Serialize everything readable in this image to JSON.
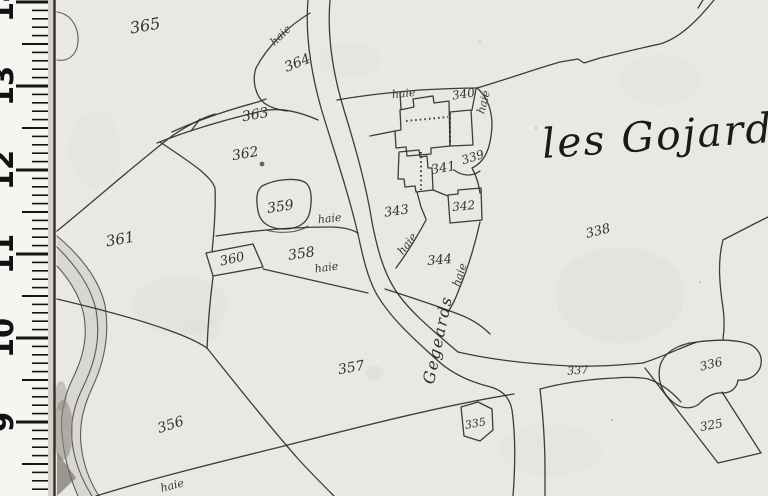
{
  "map": {
    "place_title": "les Gojards",
    "road_label": "Gegeards",
    "hedge_word": "haie",
    "ink_color": "#2f2d29",
    "paper_color": "#eae8e3",
    "parcel_numbers": [
      {
        "n": "365",
        "x": 146,
        "y": 31,
        "r": -10,
        "s": 16
      },
      {
        "n": "364",
        "x": 299,
        "y": 67,
        "r": -22,
        "s": 14
      },
      {
        "n": "363",
        "x": 256,
        "y": 119,
        "r": -10,
        "s": 14
      },
      {
        "n": "362",
        "x": 246,
        "y": 158,
        "r": -10,
        "s": 14
      },
      {
        "n": "361",
        "x": 121,
        "y": 244,
        "r": -10,
        "s": 15
      },
      {
        "n": "360",
        "x": 233,
        "y": 263,
        "r": -12,
        "s": 13
      },
      {
        "n": "359",
        "x": 281,
        "y": 211,
        "r": -8,
        "s": 14
      },
      {
        "n": "358",
        "x": 302,
        "y": 258,
        "r": -8,
        "s": 14
      },
      {
        "n": "357",
        "x": 352,
        "y": 372,
        "r": -10,
        "s": 14
      },
      {
        "n": "356",
        "x": 172,
        "y": 429,
        "r": -18,
        "s": 14
      },
      {
        "n": "343",
        "x": 397,
        "y": 215,
        "r": -8,
        "s": 13
      },
      {
        "n": "341",
        "x": 444,
        "y": 172,
        "r": -10,
        "s": 13
      },
      {
        "n": "340",
        "x": 464,
        "y": 98,
        "r": -8,
        "s": 12
      },
      {
        "n": "339",
        "x": 474,
        "y": 161,
        "r": -18,
        "s": 12
      },
      {
        "n": "342",
        "x": 464,
        "y": 210,
        "r": -5,
        "s": 12
      },
      {
        "n": "344",
        "x": 440,
        "y": 264,
        "r": -5,
        "s": 13
      },
      {
        "n": "338",
        "x": 599,
        "y": 235,
        "r": -14,
        "s": 13
      },
      {
        "n": "337",
        "x": 578,
        "y": 374,
        "r": -4,
        "s": 11
      },
      {
        "n": "336",
        "x": 712,
        "y": 368,
        "r": -14,
        "s": 12
      },
      {
        "n": "335",
        "x": 476,
        "y": 427,
        "r": -10,
        "s": 11
      },
      {
        "n": "325",
        "x": 712,
        "y": 429,
        "r": -10,
        "s": 12
      }
    ],
    "hedge_labels": [
      {
        "x": 283,
        "y": 38,
        "r": -44
      },
      {
        "x": 404,
        "y": 97,
        "r": -6
      },
      {
        "x": 487,
        "y": 103,
        "r": -75
      },
      {
        "x": 330,
        "y": 222,
        "r": -6
      },
      {
        "x": 327,
        "y": 271,
        "r": -8
      },
      {
        "x": 410,
        "y": 246,
        "r": -52
      },
      {
        "x": 463,
        "y": 276,
        "r": -72
      },
      {
        "x": 173,
        "y": 489,
        "r": -14
      }
    ],
    "ruler": {
      "numbers": [
        "14",
        "13",
        "12",
        "11",
        "10",
        "9"
      ]
    }
  }
}
